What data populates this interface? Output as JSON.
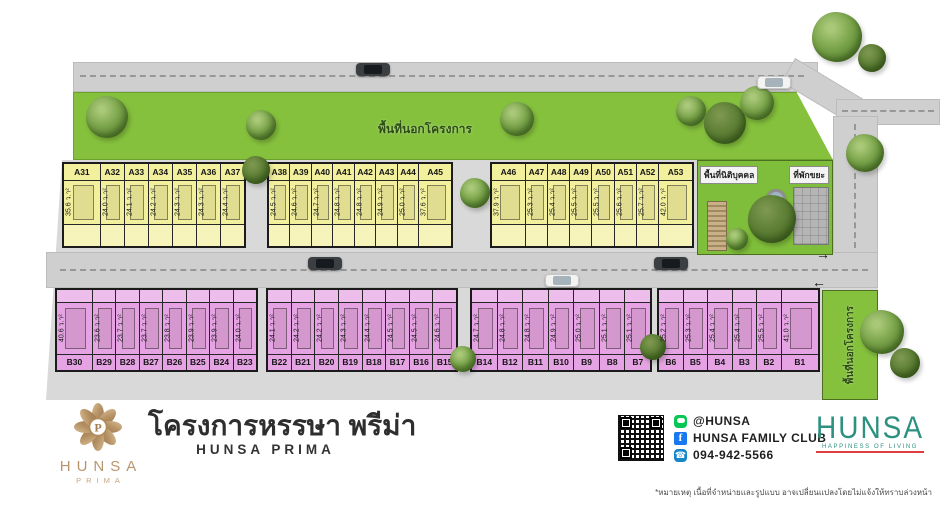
{
  "site": {
    "top_outside_label": "พื้นที่นอกโครงการ",
    "right_outside_label": "พื้นที่นอกโครงการ",
    "juristic_label": "พื้นที่นิติบุคคล",
    "garbage_label": "ที่พักขยะ",
    "area_unit": "ว.า²",
    "arrow_right": "→",
    "arrow_left": "←"
  },
  "lot_groups": [
    {
      "zone": "A",
      "name": "a-group-1",
      "lots": [
        {
          "id": "A31",
          "area": "35.6",
          "wide": true
        },
        {
          "id": "A32",
          "area": "24.0"
        },
        {
          "id": "A33",
          "area": "24.1"
        },
        {
          "id": "A34",
          "area": "24.2"
        },
        {
          "id": "A35",
          "area": "24.3"
        },
        {
          "id": "A36",
          "area": "24.3"
        },
        {
          "id": "A37",
          "area": "24.4"
        }
      ]
    },
    {
      "zone": "A",
      "name": "a-group-2",
      "lots": [
        {
          "id": "A38",
          "area": "24.5"
        },
        {
          "id": "A39",
          "area": "24.6"
        },
        {
          "id": "A40",
          "area": "24.7"
        },
        {
          "id": "A41",
          "area": "24.8"
        },
        {
          "id": "A42",
          "area": "24.8"
        },
        {
          "id": "A43",
          "area": "24.9"
        },
        {
          "id": "A44",
          "area": "25.0"
        },
        {
          "id": "A45",
          "area": "37.6",
          "wide": true
        }
      ]
    },
    {
      "zone": "A",
      "name": "a-group-3",
      "lots": [
        {
          "id": "A46",
          "area": "37.9",
          "wide": true
        },
        {
          "id": "A47",
          "area": "25.3"
        },
        {
          "id": "A48",
          "area": "25.4"
        },
        {
          "id": "A49",
          "area": "25.5"
        },
        {
          "id": "A50",
          "area": "25.5"
        },
        {
          "id": "A51",
          "area": "25.6"
        },
        {
          "id": "A52",
          "area": "25.7"
        },
        {
          "id": "A53",
          "area": "42.0",
          "wide": true
        }
      ]
    },
    {
      "zone": "B",
      "name": "b-group-1",
      "lots": [
        {
          "id": "B30",
          "area": "40.6",
          "wide": true
        },
        {
          "id": "B29",
          "area": "23.6"
        },
        {
          "id": "B28",
          "area": "23.7"
        },
        {
          "id": "B27",
          "area": "23.7"
        },
        {
          "id": "B26",
          "area": "23.8"
        },
        {
          "id": "B25",
          "area": "23.9"
        },
        {
          "id": "B24",
          "area": "23.9"
        },
        {
          "id": "B23",
          "area": "24.0"
        }
      ]
    },
    {
      "zone": "B",
      "name": "b-group-2",
      "lots": [
        {
          "id": "B22",
          "area": "24.1"
        },
        {
          "id": "B21",
          "area": "24.2"
        },
        {
          "id": "B20",
          "area": "24.2"
        },
        {
          "id": "B19",
          "area": "24.3"
        },
        {
          "id": "B18",
          "area": "24.4"
        },
        {
          "id": "B17",
          "area": "24.5"
        },
        {
          "id": "B16",
          "area": "24.5"
        },
        {
          "id": "B15",
          "area": "24.6"
        }
      ]
    },
    {
      "zone": "B",
      "name": "b-group-3",
      "lots": [
        {
          "id": "B14",
          "area": "24.7"
        },
        {
          "id": "B12",
          "area": "24.8"
        },
        {
          "id": "B11",
          "area": "24.8"
        },
        {
          "id": "B10",
          "area": "24.9"
        },
        {
          "id": "B9",
          "area": "25.0"
        },
        {
          "id": "B8",
          "area": "25.1"
        },
        {
          "id": "B7",
          "area": "25.1"
        }
      ]
    },
    {
      "zone": "B",
      "name": "b-group-4",
      "lots": [
        {
          "id": "B6",
          "area": "25.2"
        },
        {
          "id": "B5",
          "area": "25.3"
        },
        {
          "id": "B4",
          "area": "25.4"
        },
        {
          "id": "B3",
          "area": "25.4"
        },
        {
          "id": "B2",
          "area": "25.5"
        },
        {
          "id": "B1",
          "area": "41.0",
          "wide": true
        }
      ]
    }
  ],
  "footer": {
    "logo": {
      "monogram": "P",
      "line1": "HUNSA",
      "line2": "PRIMA"
    },
    "project_title_th": "โครงการหรรษา พรีม่า",
    "project_title_en": "HUNSA PRIMA",
    "contacts": [
      {
        "icon": "line-icon",
        "label": "@HUNSA"
      },
      {
        "icon": "facebook-icon",
        "label": "HUNSA FAMILY CLUB"
      },
      {
        "icon": "phone-icon",
        "label": "094-942-5566"
      }
    ],
    "facebook_glyph": "f",
    "phone_glyph": "☎",
    "brand": {
      "name": "HUNSA",
      "tagline": "HAPPINESS OF LIVING"
    },
    "disclaimer": "*หมายเหตุ เนื้อที่จำหน่ายและรูปแบบ อาจเปลี่ยนแปลงโดยไม่แจ้งให้ทราบล่วงหน้า"
  },
  "colors": {
    "lot_a_fill": "#f2ef9d",
    "lot_b_fill": "#e6a3e3",
    "green_area": "#85c13d",
    "road": "#cfcfcf",
    "parcel": "#d9d9d9",
    "brand_teal": "#2e9180",
    "brand_gold": "#b9956d",
    "accent_red": "#e23d3d",
    "line_green": "#06c755",
    "facebook_blue": "#1877f2"
  }
}
